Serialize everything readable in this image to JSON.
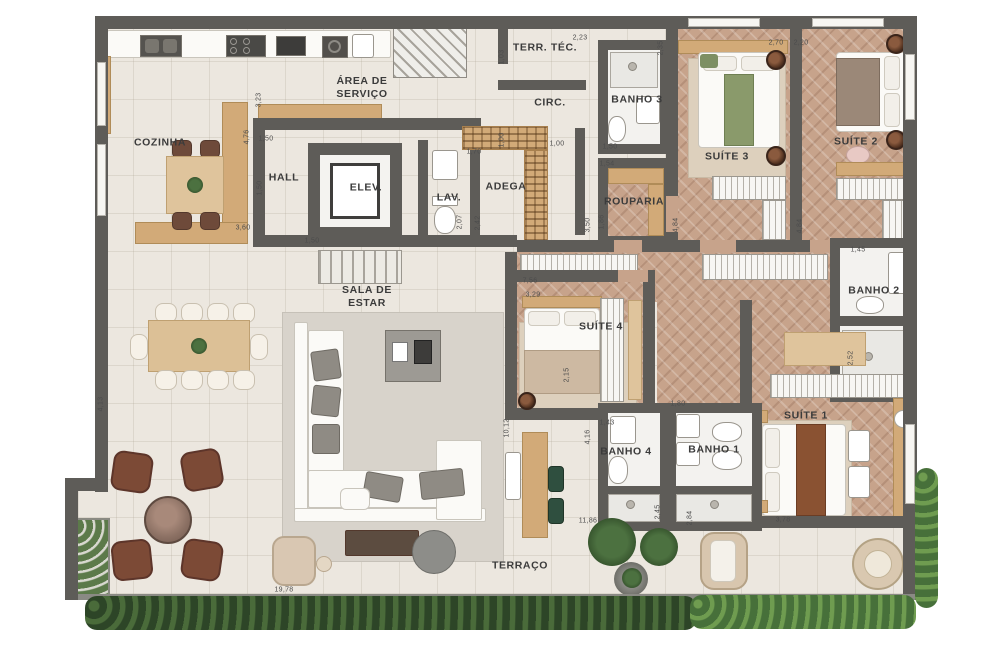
{
  "plan": {
    "title": "apartment-floor-plan",
    "room_labels": [
      {
        "id": "cozinha",
        "label": "COZINHA",
        "x": 160,
        "y": 143
      },
      {
        "id": "area-de-servico",
        "label": "ÁREA DE\nSERVIÇO",
        "x": 362,
        "y": 88
      },
      {
        "id": "hall",
        "label": "HALL",
        "x": 284,
        "y": 178
      },
      {
        "id": "elev",
        "label": "ELEV.",
        "x": 366,
        "y": 188
      },
      {
        "id": "lav",
        "label": "LAV.",
        "x": 449,
        "y": 198
      },
      {
        "id": "adega",
        "label": "ADEGA",
        "x": 506,
        "y": 187
      },
      {
        "id": "terr-tec",
        "label": "TERR. TÉC.",
        "x": 545,
        "y": 48
      },
      {
        "id": "circ",
        "label": "CIRC.",
        "x": 550,
        "y": 103
      },
      {
        "id": "banho-3",
        "label": "BANHO 3",
        "x": 637,
        "y": 100
      },
      {
        "id": "suite-3",
        "label": "SUÍTE 3",
        "x": 727,
        "y": 157
      },
      {
        "id": "suite-2",
        "label": "SUÍTE 2",
        "x": 856,
        "y": 142
      },
      {
        "id": "rouparia",
        "label": "ROUPARIA",
        "x": 634,
        "y": 202
      },
      {
        "id": "banho-2",
        "label": "BANHO 2",
        "x": 874,
        "y": 291
      },
      {
        "id": "suite-4",
        "label": "SUÍTE 4",
        "x": 601,
        "y": 327
      },
      {
        "id": "sala-de-estar",
        "label": "SALA DE\nESTAR",
        "x": 367,
        "y": 297
      },
      {
        "id": "banho-4",
        "label": "BANHO 4",
        "x": 626,
        "y": 452
      },
      {
        "id": "banho-1",
        "label": "BANHO 1",
        "x": 714,
        "y": 450
      },
      {
        "id": "suite-1",
        "label": "SUÍTE 1",
        "x": 806,
        "y": 416
      },
      {
        "id": "terraco",
        "label": "TERRAÇO",
        "x": 520,
        "y": 566
      }
    ],
    "dim_labels": [
      {
        "t": "4,76",
        "x": 247,
        "y": 137,
        "v": true
      },
      {
        "t": "3,23",
        "x": 259,
        "y": 100,
        "v": true
      },
      {
        "t": "1,50",
        "x": 266,
        "y": 139,
        "v": false
      },
      {
        "t": "1,50",
        "x": 260,
        "y": 188,
        "v": true
      },
      {
        "t": "3,60",
        "x": 243,
        "y": 228,
        "v": false
      },
      {
        "t": "1,50",
        "x": 312,
        "y": 241,
        "v": false
      },
      {
        "t": "1,03",
        "x": 502,
        "y": 57,
        "v": true
      },
      {
        "t": "2,23",
        "x": 580,
        "y": 38,
        "v": false
      },
      {
        "t": "1,00",
        "x": 502,
        "y": 140,
        "v": true
      },
      {
        "t": "1,70",
        "x": 474,
        "y": 152,
        "v": false
      },
      {
        "t": "1,00",
        "x": 557,
        "y": 144,
        "v": false
      },
      {
        "t": "1,50",
        "x": 610,
        "y": 147,
        "v": false
      },
      {
        "t": "2,35",
        "x": 661,
        "y": 48,
        "v": true
      },
      {
        "t": "2,70",
        "x": 776,
        "y": 43,
        "v": false
      },
      {
        "t": "2,20",
        "x": 801,
        "y": 43,
        "v": false
      },
      {
        "t": "1,54",
        "x": 607,
        "y": 164,
        "v": false
      },
      {
        "t": "3,50",
        "x": 588,
        "y": 225,
        "v": true
      },
      {
        "t": "1,86",
        "x": 602,
        "y": 222,
        "v": true
      },
      {
        "t": "2,07",
        "x": 460,
        "y": 222,
        "v": true
      },
      {
        "t": "2,42",
        "x": 478,
        "y": 223,
        "v": true
      },
      {
        "t": "4,84",
        "x": 676,
        "y": 225,
        "v": true
      },
      {
        "t": "4,84",
        "x": 800,
        "y": 226,
        "v": true
      },
      {
        "t": "1,45",
        "x": 858,
        "y": 250,
        "v": false
      },
      {
        "t": "2,52",
        "x": 851,
        "y": 358,
        "v": true
      },
      {
        "t": "7,56",
        "x": 530,
        "y": 281,
        "v": false
      },
      {
        "t": "3,29",
        "x": 533,
        "y": 295,
        "v": false
      },
      {
        "t": "2,15",
        "x": 567,
        "y": 375,
        "v": true
      },
      {
        "t": "1,80",
        "x": 678,
        "y": 404,
        "v": false
      },
      {
        "t": "1,43",
        "x": 607,
        "y": 423,
        "v": false
      },
      {
        "t": "10,12",
        "x": 507,
        "y": 428,
        "v": true
      },
      {
        "t": "4,16",
        "x": 588,
        "y": 437,
        "v": true
      },
      {
        "t": "2,45",
        "x": 658,
        "y": 512,
        "v": true
      },
      {
        "t": "2,84",
        "x": 690,
        "y": 518,
        "v": true
      },
      {
        "t": "11,86",
        "x": 588,
        "y": 521,
        "v": false
      },
      {
        "t": "3,78",
        "x": 783,
        "y": 520,
        "v": false
      },
      {
        "t": "4,13",
        "x": 101,
        "y": 404,
        "v": true
      },
      {
        "t": "19,78",
        "x": 284,
        "y": 590,
        "v": false
      }
    ],
    "colors": {
      "wall": "#5e5c58",
      "tile_floor": "#ece7df",
      "wood_floor": "#c7a38b",
      "wood_furniture": "#d2aa78",
      "hedge_dark": "#2d4527",
      "hedge_light": "#47703a",
      "armchair_brown": "#7c4a36",
      "rug_gray": "#d8d3cb"
    }
  }
}
